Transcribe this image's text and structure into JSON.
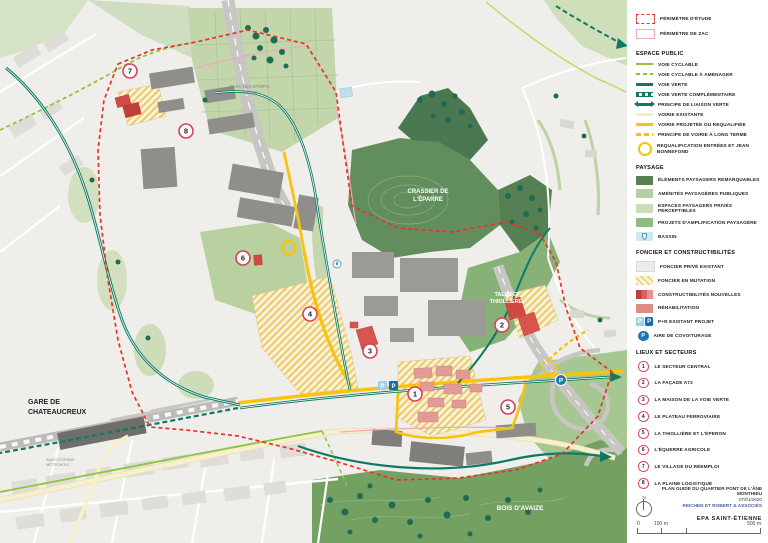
{
  "map": {
    "p_label": "P",
    "labels": {
      "parc_line1": "PARC DES SPORTS",
      "parc_line2": "MÉONS",
      "crassier_line1": "CRASSIER DE",
      "crassier_line2": "L'ÉPARRE",
      "talweg_line1": "TALWEG",
      "talweg_line2": "THIOLLIÈRE",
      "bois": "BOIS D'AVAIZE",
      "gare_line1": "GARE DE",
      "gare_line2": "CHATEAUCREUX",
      "metropole_line1": "SAINT-ÉTIENNE",
      "metropole_line2": "MÉTROPOLE"
    },
    "markers": [
      "1",
      "2",
      "3",
      "4",
      "5",
      "6",
      "7",
      "8"
    ]
  },
  "legend": {
    "perimeters": {
      "items": [
        {
          "label": "PÉRIMÈTRE D'ÉTUDE"
        },
        {
          "label": "PÉRIMÈTRE DE ZAC"
        }
      ]
    },
    "espace_public": {
      "title": "ESPACE PUBLIC",
      "items": [
        {
          "label": "VOIE CYCLABLE"
        },
        {
          "label": "VOIE CYCLABLE À AMÉNAGER"
        },
        {
          "label": "VOIE VERTE"
        },
        {
          "label": "VOIE VERTE COMPLÉMENTAIRE"
        },
        {
          "label": "PRINCIPE DE LIAISON VERTE"
        },
        {
          "label": "VOIRIE EXISTANTE"
        },
        {
          "label": "VOIRIE PROJETÉE OU REQUALIFIÉE"
        },
        {
          "label": "PRINCIPE DE VOIRIE À LONG TERME"
        },
        {
          "label": "REQUALIFICATION ENTRÉES ET JEAN BONNEFOND"
        }
      ]
    },
    "paysage": {
      "title": "PAYSAGE",
      "items": [
        {
          "label": "ÉLÉMENTS PAYSAGERS REMARQUABLES"
        },
        {
          "label": "AMÉNITÉS PAYSAGÈRES PUBLIQUES"
        },
        {
          "label": "ESPACES PAYSAGERS PRIVÉS PERCEPTIBLES"
        },
        {
          "label": "PROJETS D'AMPLIFICATION PAYSAGÈRE"
        },
        {
          "label": "BASSIN"
        }
      ]
    },
    "foncier": {
      "title": "FONCIER ET CONSTRUCTIBILITÉS",
      "items": [
        {
          "label": "FONCIER PRIVÉ EXISTANT"
        },
        {
          "label": "FONCIER EN MUTATION"
        },
        {
          "label": "CONSTRUCTIBILITÉS NOUVELLES"
        },
        {
          "label": "RÉHABILITATION"
        },
        {
          "label": "P+R EXISTANT PROJET"
        },
        {
          "label": "AIRE DE COVOITURAGE"
        }
      ]
    },
    "lieux": {
      "title": "LIEUX ET SECTEURS",
      "items": [
        {
          "num": "1",
          "label": "LE SECTEUR CENTRAL"
        },
        {
          "num": "2",
          "label": "LA FAÇADE A72"
        },
        {
          "num": "3",
          "label": "LA MAISON DE LA VOIE VERTE"
        },
        {
          "num": "4",
          "label": "LE PLATEAU FERROVIAIRE"
        },
        {
          "num": "5",
          "label": "LA THIOLLIÈRE ET L'ÉPERON"
        },
        {
          "num": "6",
          "label": "L'ÉQUERRE AGRICOLE"
        },
        {
          "num": "7",
          "label": "LE VILLAGE DU RÉEMPLOI"
        },
        {
          "num": "8",
          "label": "LA PLAINE LOGISTIQUE"
        }
      ]
    }
  },
  "titleblock": {
    "title": "PLAN GUIDE DU QUARTIER PONT DE L'ÂNE MONTHIEU",
    "date": "07/01/2020",
    "author": "REICHEN ET ROBERT & ASSOCIÉS",
    "agency": "EPA SAINT-ÉTIENNE",
    "north_label": "N",
    "scale_start": "0",
    "scale_mid": "100 m",
    "scale_end": "500 m"
  },
  "colors": {
    "perimeter_red": "#E8322A",
    "zac_pink": "#F0A8BC",
    "voie_verte_teal": "#0E7A66",
    "cycle_green": "#8CC63F",
    "road_yellow": "#F6C40E",
    "parking_blue": "#1878B4",
    "sector_pink": "#D8415A"
  }
}
